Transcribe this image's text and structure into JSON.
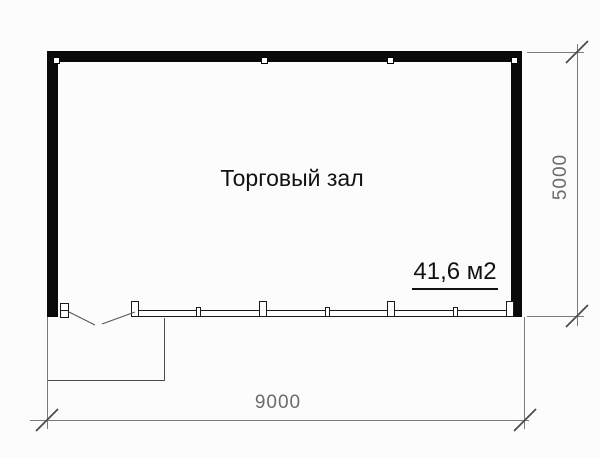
{
  "plan": {
    "room_label": "Торговый зал",
    "area_label": "41,6 м2",
    "width_dimension": "9000",
    "height_dimension": "5000"
  },
  "colors": {
    "wall": "#0a0a0a",
    "dim_line": "#7a7a7a",
    "dim_text": "#6b6b6b",
    "label_text": "#111111",
    "background": "#fcfcfc"
  }
}
